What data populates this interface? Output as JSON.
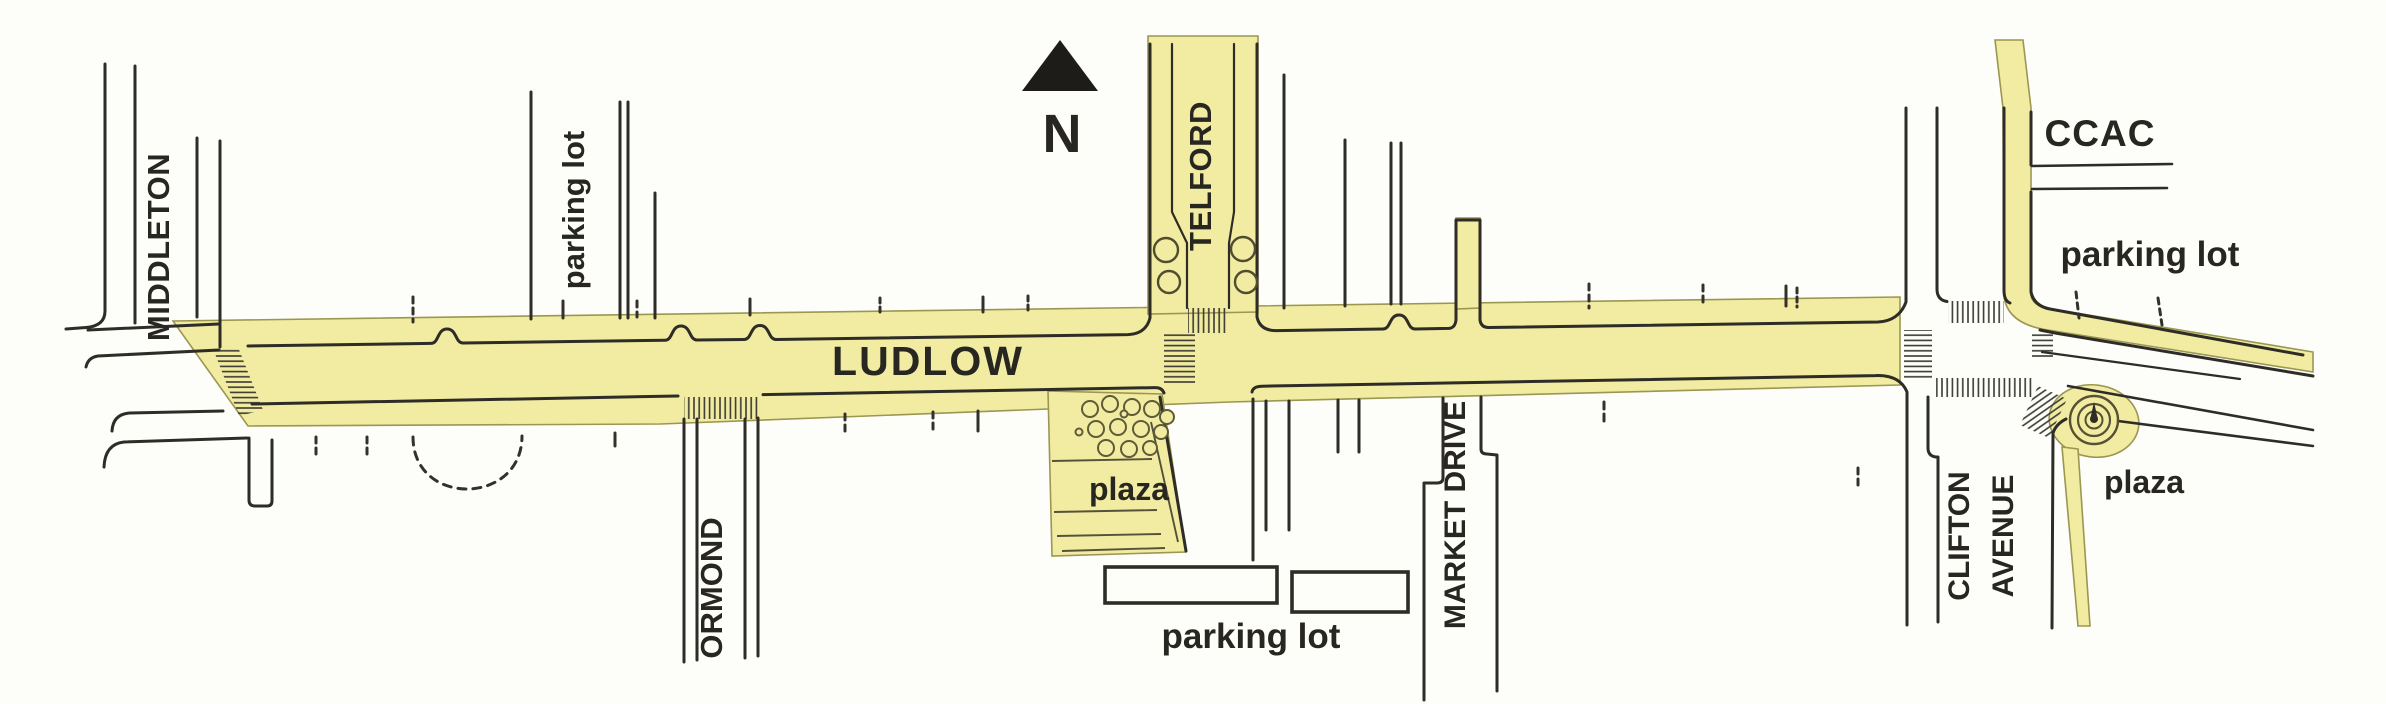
{
  "map": {
    "compass": {
      "letter": "N",
      "icon": "north-arrow-icon"
    },
    "streets": {
      "middleton": "MIDDLETON",
      "ludlow": "LUDLOW",
      "ormond": "ORMOND",
      "telford": "TELFORD",
      "market_drive": "MARKET DRIVE",
      "clifton_avenue_line1": "CLIFTON",
      "clifton_avenue_line2": "AVENUE"
    },
    "places": {
      "ccac": "CCAC",
      "parking_lot_west": "parking lot",
      "parking_lot_south": "parking lot",
      "parking_lot_northeast": "parking lot",
      "plaza_central": "plaza",
      "plaza_east": "plaza"
    },
    "colors": {
      "highlight": "#f1eca1",
      "highlight_edge": "#9b9752",
      "line": "#2e2c27",
      "text": "#272621",
      "arrow": "#1d1c19",
      "background": "#fdfdfa"
    }
  }
}
